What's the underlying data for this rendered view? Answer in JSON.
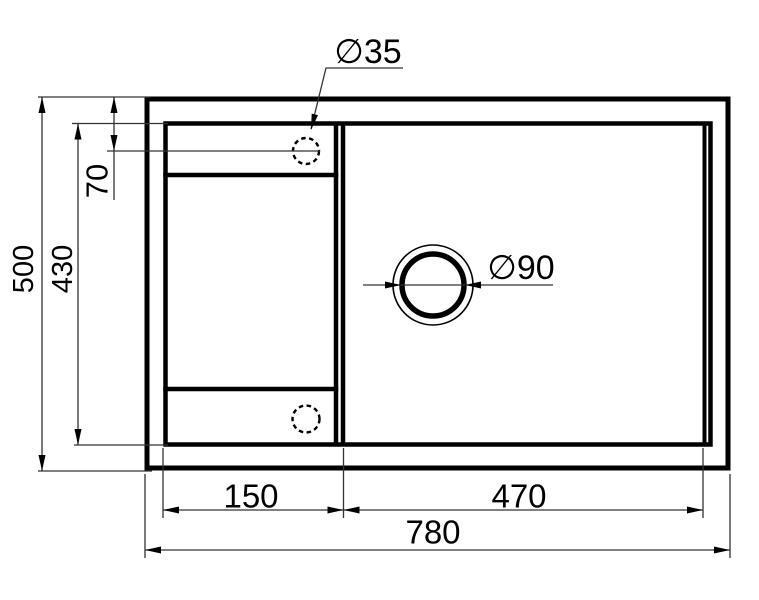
{
  "drawing": {
    "dimensions": {
      "overall_width": "780",
      "overall_height": "500",
      "inner_height": "430",
      "hole_offset_top": "70",
      "left_bowl_width": "150",
      "main_bowl_width": "470",
      "faucet_hole_diameter": "∅35",
      "drain_hole_diameter": "∅90"
    },
    "colors": {
      "main_line": "#000000",
      "thin_line": "#333333",
      "background": "#ffffff"
    }
  }
}
